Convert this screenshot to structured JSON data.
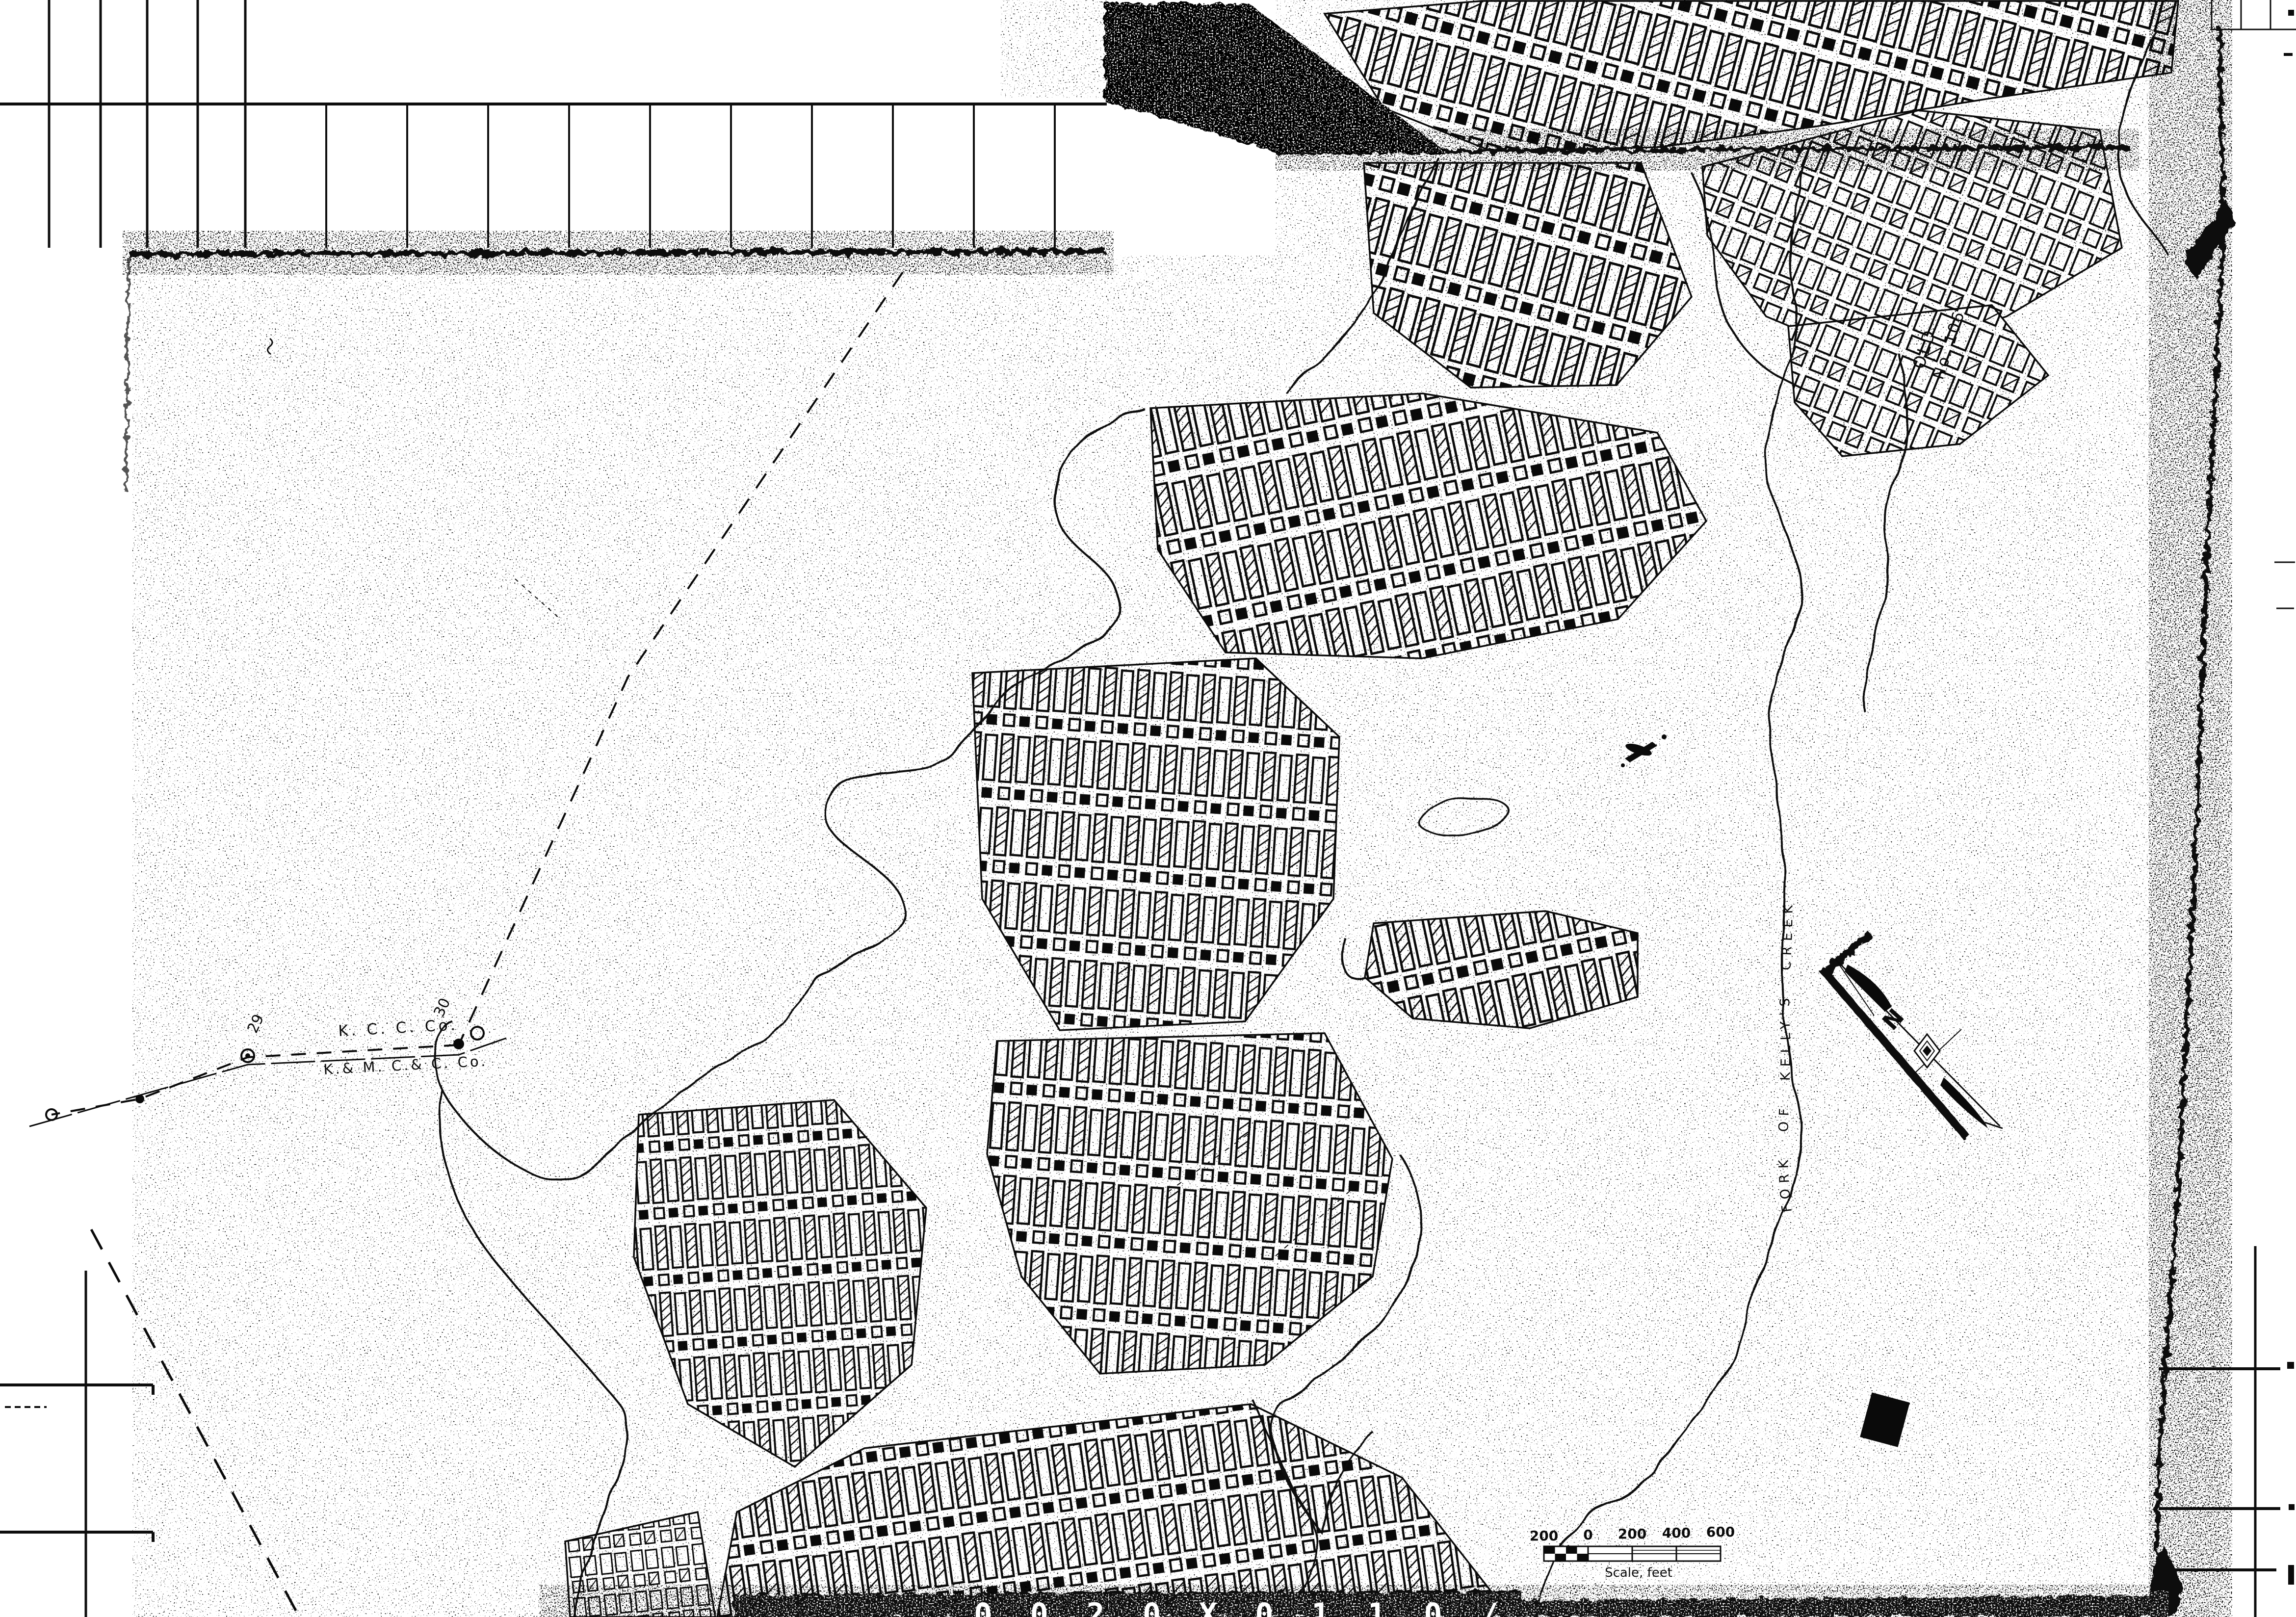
{
  "labels": {
    "creek": "FORK OF KELLY'S CREEK",
    "old_workings_line1": "OLD",
    "old_workings_line2": "No. 106",
    "company_upper": "K. C. C. Co.",
    "company_lower": "K.& M. C.& C. Co.",
    "station_a": "29",
    "station_b": "30",
    "north": "N",
    "sheet_number": "2",
    "bottom_stamp": "0 0  2 0 X    0 1 1 0 /"
  },
  "scale_bar": {
    "ticks": [
      "200",
      "0",
      "200",
      "400",
      "600"
    ],
    "caption": "Scale, feet"
  },
  "colors": {
    "ink": "#0a0a0a",
    "paper": "#ffffff"
  }
}
